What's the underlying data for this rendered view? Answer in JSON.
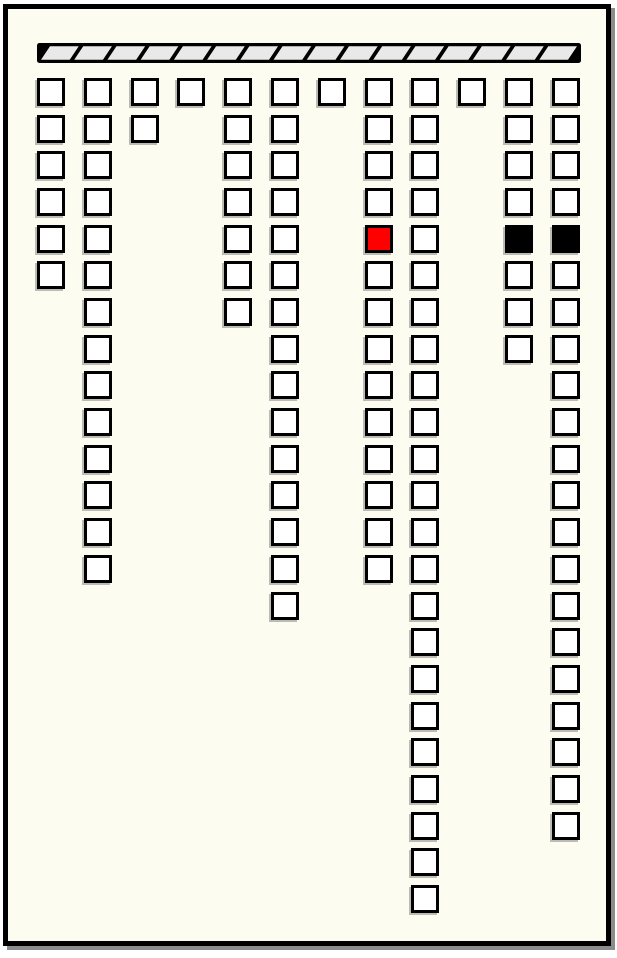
{
  "panel": {
    "background_color": "#fcfcf1",
    "frame_border_color": "#000000",
    "shadow_color": "#8c8c8c"
  },
  "header_bar": {
    "x": 34,
    "y": 40,
    "width": 550,
    "height": 26,
    "border_color": "#000000",
    "segment_fill": "#e9e9e9",
    "segment_count": 16,
    "segment_slant": 9,
    "segment_gap": 4.5,
    "inner_inset": 3.2
  },
  "grid": {
    "origin_x": 37,
    "origin_y": 78,
    "col_pitch": 46.8,
    "row_pitch": 36.68,
    "cell_size": 28,
    "cell_border_color": "#000000",
    "state_colors": {
      "w": "#ffffff",
      "r": "#ff0000",
      "b": "#000000"
    },
    "columns": [
      {
        "cells": "wwwwww"
      },
      {
        "cells": "wwwwwwwwwwwwww"
      },
      {
        "cells": "ww"
      },
      {
        "cells": "w"
      },
      {
        "cells": "wwwwwww"
      },
      {
        "cells": "wwwwwwwwwwwwwww"
      },
      {
        "cells": "w"
      },
      {
        "cells": "wwwwrwwwwwwwww"
      },
      {
        "cells": "wwwwwwwwwwwwwwwwwwwwwww"
      },
      {
        "cells": "w"
      },
      {
        "cells": "wwwwbwww"
      },
      {
        "cells": "wwwwbwwwwwwwwwwwwwwww"
      }
    ]
  }
}
